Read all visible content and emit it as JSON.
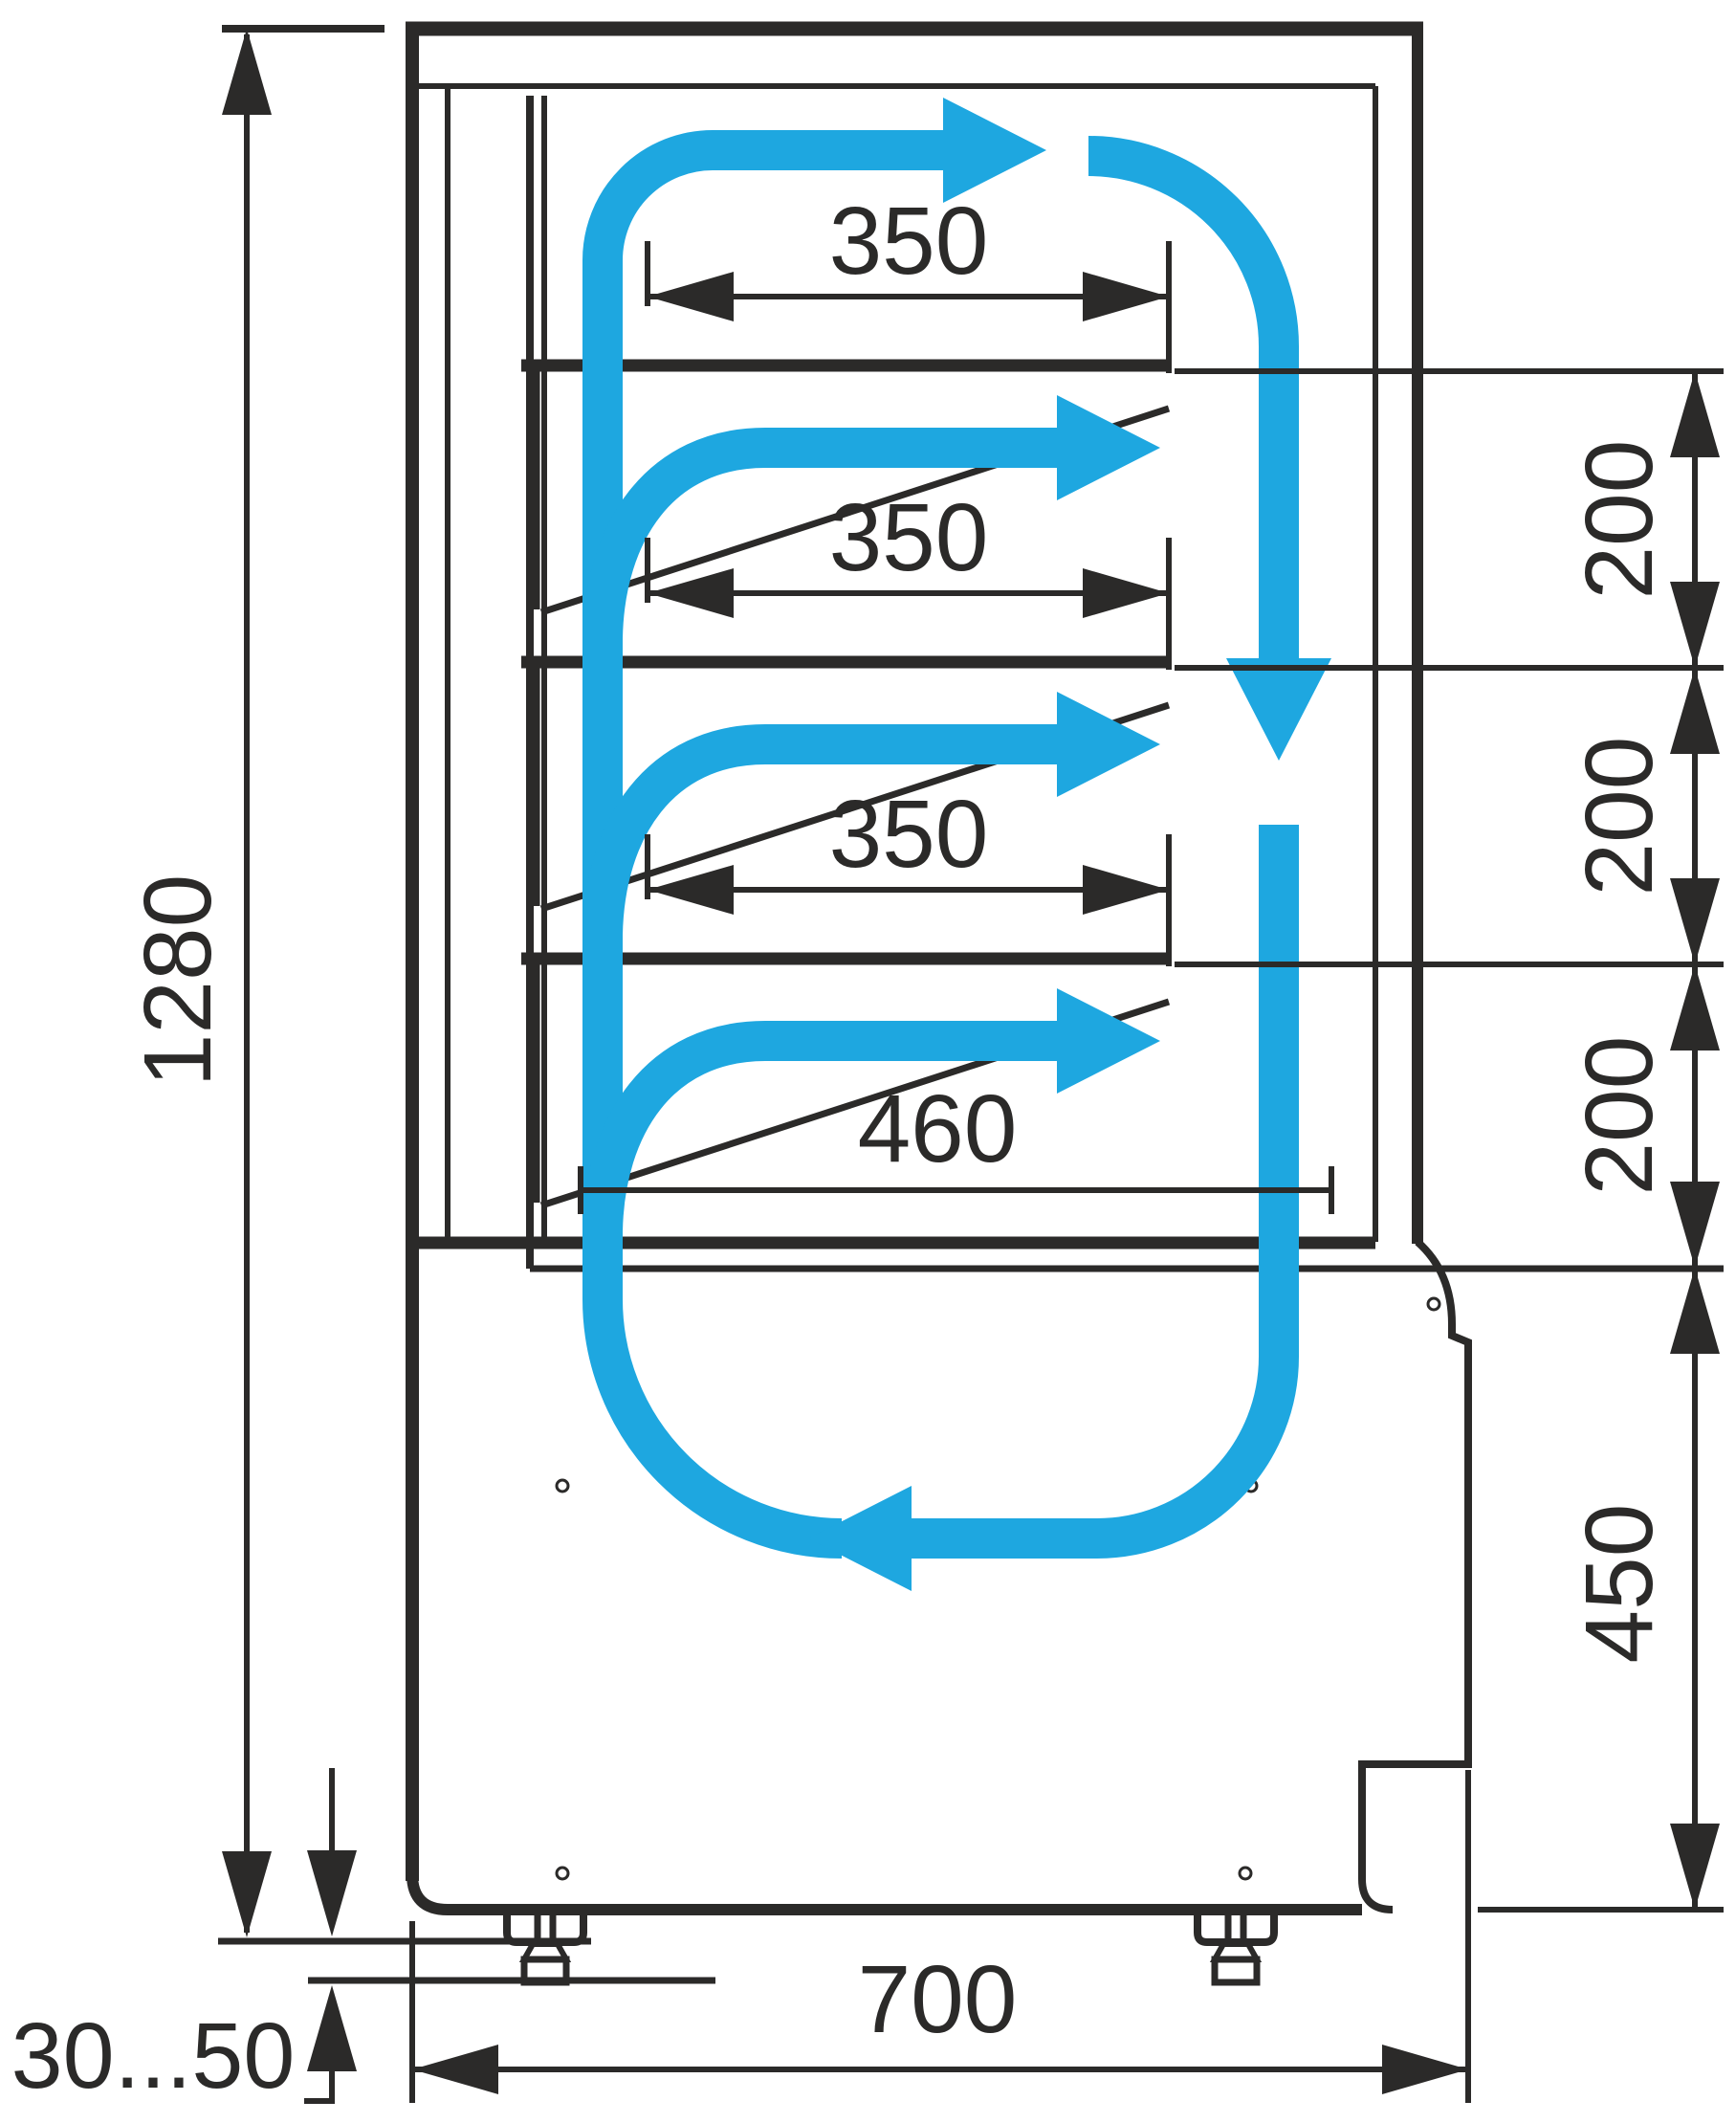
{
  "drawing": {
    "kind": "refrigerated-display-case-side-section",
    "units_note": ""
  },
  "colors": {
    "line": "#2b2a29",
    "flow": "#1ea7e0",
    "background": "#ffffff"
  },
  "dims": {
    "overall_height": "1280",
    "shelf_350_1": "350",
    "shelf_350_2": "350",
    "shelf_350_3": "350",
    "deck_460": "460",
    "gap_200_1": "200",
    "gap_200_2": "200",
    "gap_200_3": "200",
    "base_450": "450",
    "depth_700": "700",
    "legs_30_50": "30...50"
  }
}
